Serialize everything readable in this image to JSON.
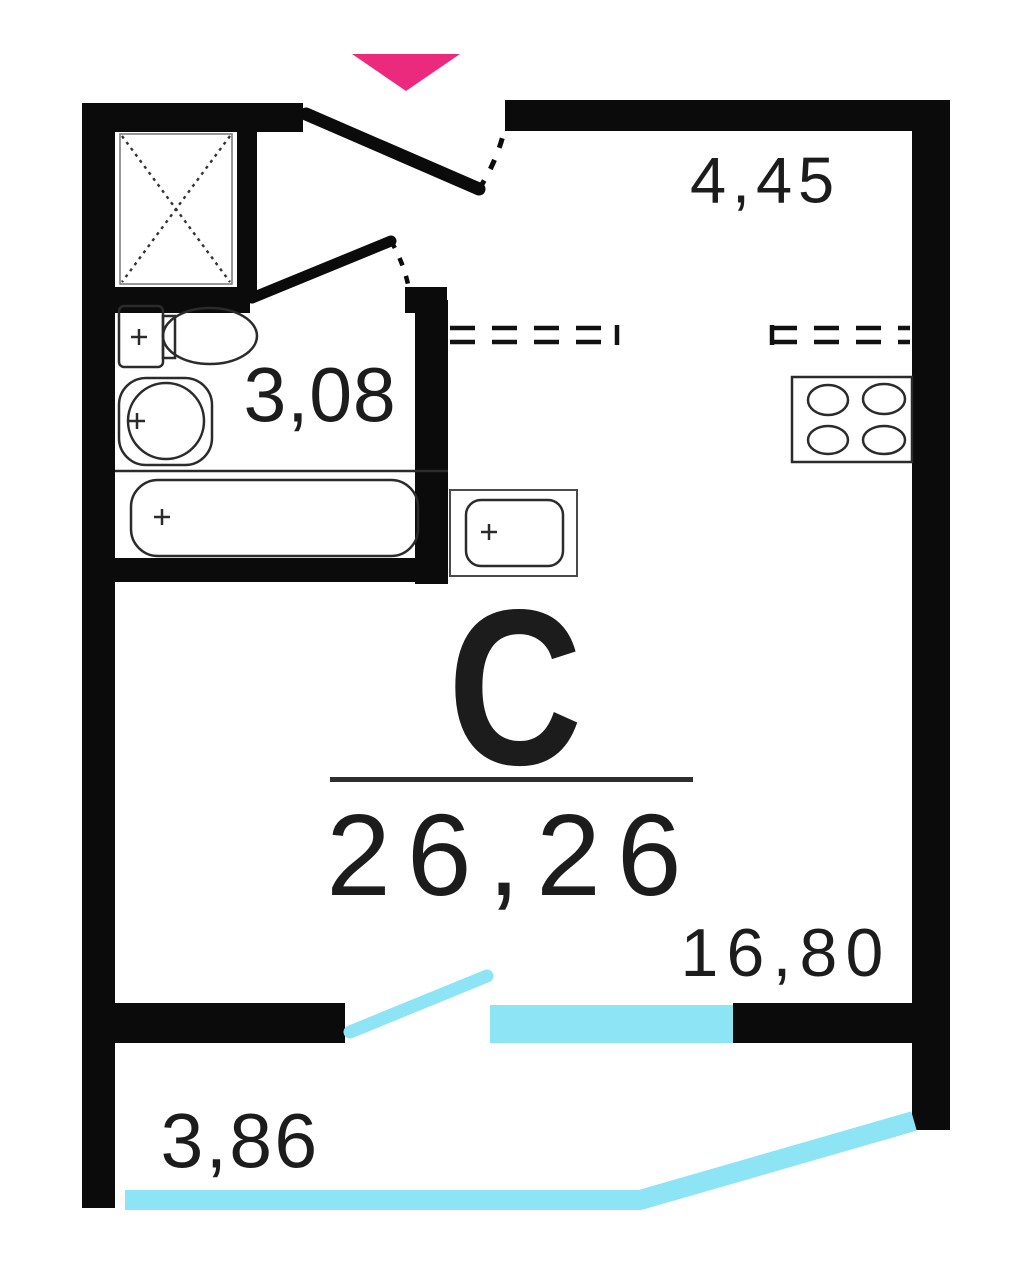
{
  "plan": {
    "type_label": "С",
    "total_area": "26,26",
    "areas": {
      "kitchen_hall": "4,45",
      "bathroom": "3,08",
      "living_room": "16,80",
      "balcony": "3,86"
    }
  },
  "colors": {
    "walls": "#0b0b0b",
    "fixture_lines": "#2b2b2b",
    "entrance_arrow": "#ec2a7d",
    "glazing": "#8ce4f4",
    "text": "#1c1c1c",
    "background": "#ffffff"
  },
  "icons": {
    "entrance_marker": "triangle-down-icon",
    "ventilation_shaft": "crossed-box-icon",
    "fixtures": [
      "toilet-icon",
      "washbasin-icon",
      "bathtub-icon",
      "kitchen-sink-icon",
      "stove-4-burner-icon"
    ]
  }
}
